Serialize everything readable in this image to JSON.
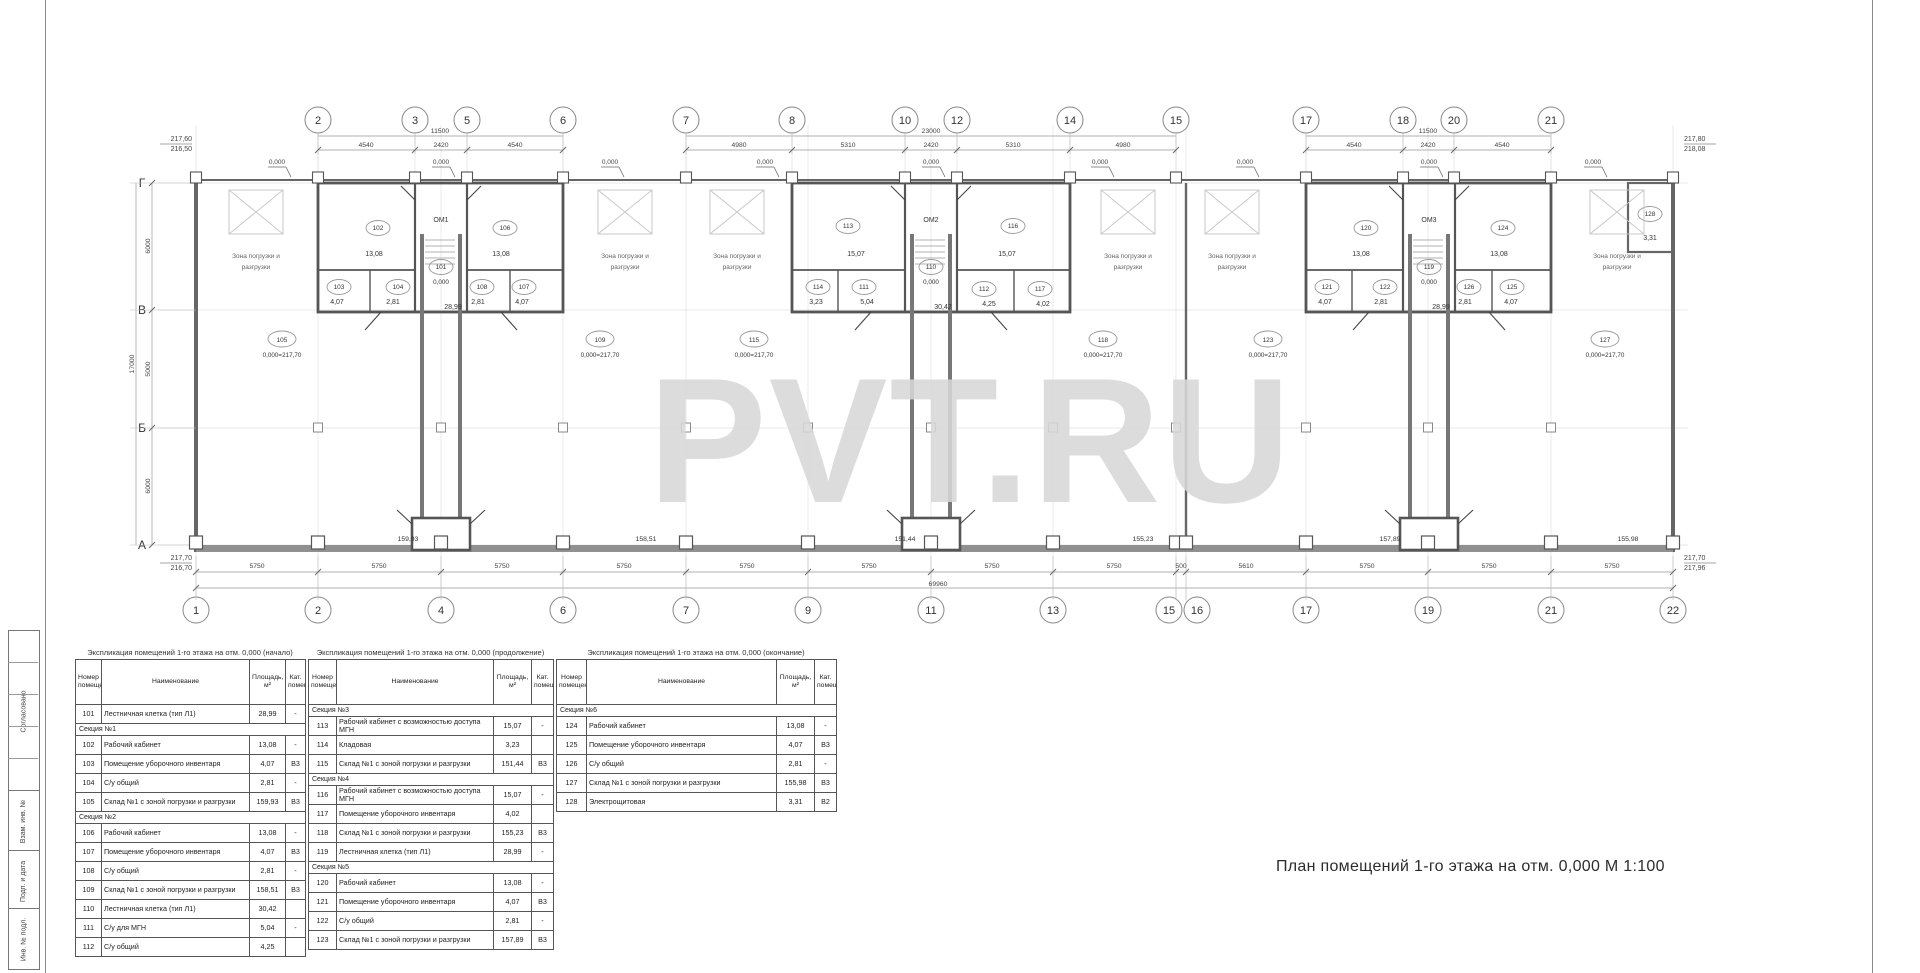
{
  "watermark": "PVT.RU",
  "title": "План помещений 1-го этажа на отм. 0,000 М 1:100",
  "stamp_labels": [
    "Согласовано",
    "Взам. инв. №",
    "Подп. и дата",
    "Инв. № подл."
  ],
  "plan": {
    "row_letters": [
      "Г",
      "В",
      "Б",
      "А"
    ],
    "top_grids": [
      "2",
      "3",
      "5",
      "6",
      "7",
      "8",
      "10",
      "12",
      "14",
      "15",
      "17",
      "18",
      "20",
      "21"
    ],
    "bottom_grids": [
      "1",
      "2",
      "4",
      "6",
      "7",
      "9",
      "11",
      "13",
      "15",
      "16",
      "17",
      "19",
      "21",
      "22"
    ],
    "top_dim_totals": [
      "11500",
      "23000",
      "11500"
    ],
    "top_dim_segments": [
      "4540",
      "2420",
      "4540",
      "4980",
      "5310",
      "2420",
      "5310",
      "4980",
      "4540",
      "2420",
      "4540"
    ],
    "bottom_dim_segments": [
      "5750",
      "5750",
      "5750",
      "5750",
      "5750",
      "5750",
      "5750",
      "5750",
      "500",
      "5610",
      "5750",
      "5750",
      "5750"
    ],
    "bottom_dim_total": "69960",
    "left_dims": [
      "6000",
      "5000",
      "6000"
    ],
    "left_dim_total": "17000",
    "zero_mark": "0,000",
    "zone_line1": "Зона погрузки и",
    "zone_line2": "разгрузки",
    "elevations": {
      "top_left": [
        "217,60",
        "216,50"
      ],
      "bottom_left": [
        "217,70",
        "216,70"
      ],
      "top_right": [
        "217,80",
        "218,08"
      ],
      "bottom_right": [
        "217,70",
        "217,96"
      ]
    },
    "stairs": [
      {
        "label": "ОМ1",
        "num": "101",
        "level": "0,000",
        "area": "28,99"
      },
      {
        "label": "ОМ2",
        "num": "110",
        "level": "0,000",
        "area": "30,42"
      },
      {
        "label": "ОМ3",
        "num": "119",
        "level": "0,000",
        "area": "28,99"
      }
    ],
    "rooms": [
      {
        "num": "102",
        "area": "13,08"
      },
      {
        "num": "106",
        "area": "13,08"
      },
      {
        "num": "103",
        "area": "4,07"
      },
      {
        "num": "104",
        "area": "2,81"
      },
      {
        "num": "108",
        "area": "2,81"
      },
      {
        "num": "107",
        "area": "4,07"
      },
      {
        "num": "113",
        "area": "15,07"
      },
      {
        "num": "116",
        "area": "15,07"
      },
      {
        "num": "114",
        "area": "3,23"
      },
      {
        "num": "111",
        "area": "5,04"
      },
      {
        "num": "112",
        "area": "4,25"
      },
      {
        "num": "117",
        "area": "4,02"
      },
      {
        "num": "120",
        "area": "13,08"
      },
      {
        "num": "124",
        "area": "13,08"
      },
      {
        "num": "121",
        "area": "4,07"
      },
      {
        "num": "122",
        "area": "2,81"
      },
      {
        "num": "126",
        "area": "2,81"
      },
      {
        "num": "125",
        "area": "4,07"
      },
      {
        "num": "128",
        "area": "3,31"
      }
    ],
    "warehouses": [
      {
        "num": "105",
        "level": "0,000=217,70",
        "area": "159,93"
      },
      {
        "num": "109",
        "level": "0,000=217,70",
        "area": "158,51"
      },
      {
        "num": "115",
        "level": "0,000=217,70",
        "area": "151,44"
      },
      {
        "num": "118",
        "level": "0,000=217,70",
        "area": "155,23"
      },
      {
        "num": "123",
        "level": "0,000=217,70",
        "area": "157,89"
      },
      {
        "num": "127",
        "level": "0,000=217,70",
        "area": "155,98"
      }
    ]
  },
  "tables": [
    {
      "title": "Экспликация помещений 1-го этажа на отм. 0,000 (начало)",
      "headers": [
        "Номер помещения",
        "Наименование",
        "Площадь, м²",
        "Кат. помещения"
      ],
      "rows": [
        {
          "num": "101",
          "name": "Лестничная клетка (тип Л1)",
          "area": "28,99",
          "cat": "-"
        },
        {
          "section": "Секция №1"
        },
        {
          "num": "102",
          "name": "Рабочий кабинет",
          "area": "13,08",
          "cat": "-"
        },
        {
          "num": "103",
          "name": "Помещение уборочного инвентаря",
          "area": "4,07",
          "cat": "В3"
        },
        {
          "num": "104",
          "name": "С/у общий",
          "area": "2,81",
          "cat": "-"
        },
        {
          "num": "105",
          "name": "Склад №1 с зоной погрузки и разгрузки",
          "area": "159,93",
          "cat": "В3"
        },
        {
          "section": "Секция №2"
        },
        {
          "num": "106",
          "name": "Рабочий кабинет",
          "area": "13,08",
          "cat": "-"
        },
        {
          "num": "107",
          "name": "Помещение уборочного инвентаря",
          "area": "4,07",
          "cat": "В3"
        },
        {
          "num": "108",
          "name": "С/у общий",
          "area": "2,81",
          "cat": "-"
        },
        {
          "num": "109",
          "name": "Склад №1 с зоной погрузки и разгрузки",
          "area": "158,51",
          "cat": "В3"
        },
        {
          "num": "110",
          "name": "Лестничная клетка (тип Л1)",
          "area": "30,42",
          "cat": ""
        },
        {
          "num": "111",
          "name": "С/у для МГН",
          "area": "5,04",
          "cat": "-"
        },
        {
          "num": "112",
          "name": "С/у общий",
          "area": "4,25",
          "cat": ""
        }
      ]
    },
    {
      "title": "Экспликация помещений 1-го этажа на отм. 0,000 (продолжение)",
      "headers": [
        "Номер помещения",
        "Наименование",
        "Площадь, м²",
        "Кат. помещения"
      ],
      "rows": [
        {
          "section": "Секция №3"
        },
        {
          "num": "113",
          "name": "Рабочий кабинет с возможностью доступа МГН",
          "area": "15,07",
          "cat": "-"
        },
        {
          "num": "114",
          "name": "Кладовая",
          "area": "3,23",
          "cat": ""
        },
        {
          "num": "115",
          "name": "Склад №1 с зоной погрузки и разгрузки",
          "area": "151,44",
          "cat": "В3"
        },
        {
          "section": "Секция №4"
        },
        {
          "num": "116",
          "name": "Рабочий кабинет с возможностью доступа МГН",
          "area": "15,07",
          "cat": "-"
        },
        {
          "num": "117",
          "name": "Помещение уборочного инвентаря",
          "area": "4,02",
          "cat": ""
        },
        {
          "num": "118",
          "name": "Склад №1 с зоной погрузки и разгрузки",
          "area": "155,23",
          "cat": "В3"
        },
        {
          "num": "119",
          "name": "Лестничная клетка (тип Л1)",
          "area": "28,99",
          "cat": "-"
        },
        {
          "section": "Секция №5"
        },
        {
          "num": "120",
          "name": "Рабочий кабинет",
          "area": "13,08",
          "cat": "-"
        },
        {
          "num": "121",
          "name": "Помещение уборочного инвентаря",
          "area": "4,07",
          "cat": "В3"
        },
        {
          "num": "122",
          "name": "С/у общий",
          "area": "2,81",
          "cat": "-"
        },
        {
          "num": "123",
          "name": "Склад №1 с зоной погрузки и разгрузки",
          "area": "157,89",
          "cat": "В3"
        }
      ]
    },
    {
      "title": "Экспликация помещений 1-го этажа на отм. 0,000 (окончание)",
      "headers": [
        "Номер помещения",
        "Наименование",
        "Площадь, м²",
        "Кат. помещения"
      ],
      "rows": [
        {
          "section": "Секция №6"
        },
        {
          "num": "124",
          "name": "Рабочий кабинет",
          "area": "13,08",
          "cat": "-"
        },
        {
          "num": "125",
          "name": "Помещение уборочного инвентаря",
          "area": "4,07",
          "cat": "В3"
        },
        {
          "num": "126",
          "name": "С/у общий",
          "area": "2,81",
          "cat": "-"
        },
        {
          "num": "127",
          "name": "Склад №1 с зоной погрузки и разгрузки",
          "area": "155,98",
          "cat": "В3"
        },
        {
          "num": "128",
          "name": "Электрощитовая",
          "area": "3,31",
          "cat": "В2"
        }
      ]
    }
  ]
}
